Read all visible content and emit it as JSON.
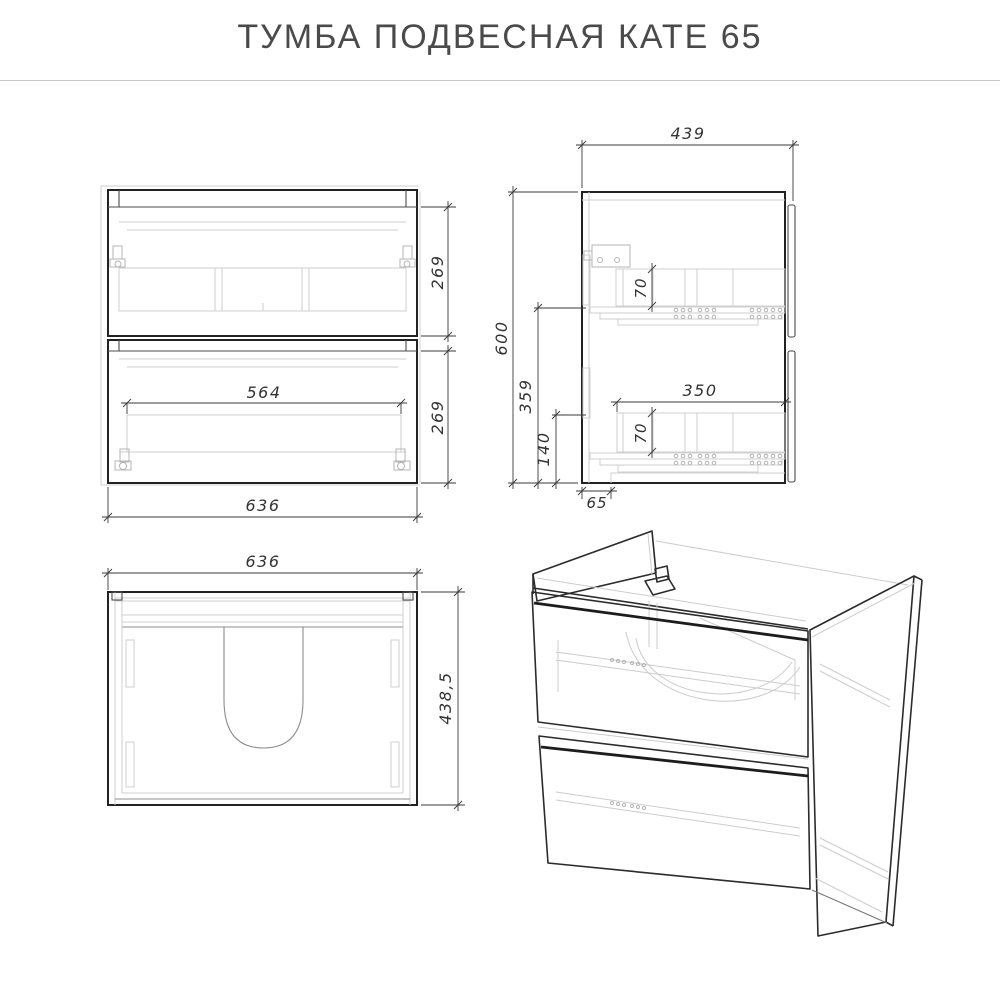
{
  "title": "ТУМБА ПОДВЕСНАЯ КАТЕ 65",
  "drawing": {
    "type": "furniture-technical-drawing",
    "views": [
      "front",
      "side",
      "top",
      "isometric"
    ]
  },
  "dimensions": {
    "front_width": "636",
    "front_inner_width": "564",
    "front_upper_drawer_height": "269",
    "front_lower_drawer_height": "269",
    "side_depth": "439",
    "side_height": "600",
    "side_upper_slide_offset": "359",
    "side_lower_slide_offset": "140",
    "side_upper_box_height": "70",
    "side_lower_box_height": "70",
    "side_drawer_depth": "350",
    "side_back_offset": "65",
    "top_width": "636",
    "top_depth": "438,5"
  },
  "colors": {
    "background": "#ffffff",
    "line_dark": "#222222",
    "line_medium": "#4a4a4a",
    "line_light": "#cfcfcf",
    "dimension": "#3a3a3a",
    "title_text": "#4a4a4a",
    "rule": "#c9c9c9"
  }
}
